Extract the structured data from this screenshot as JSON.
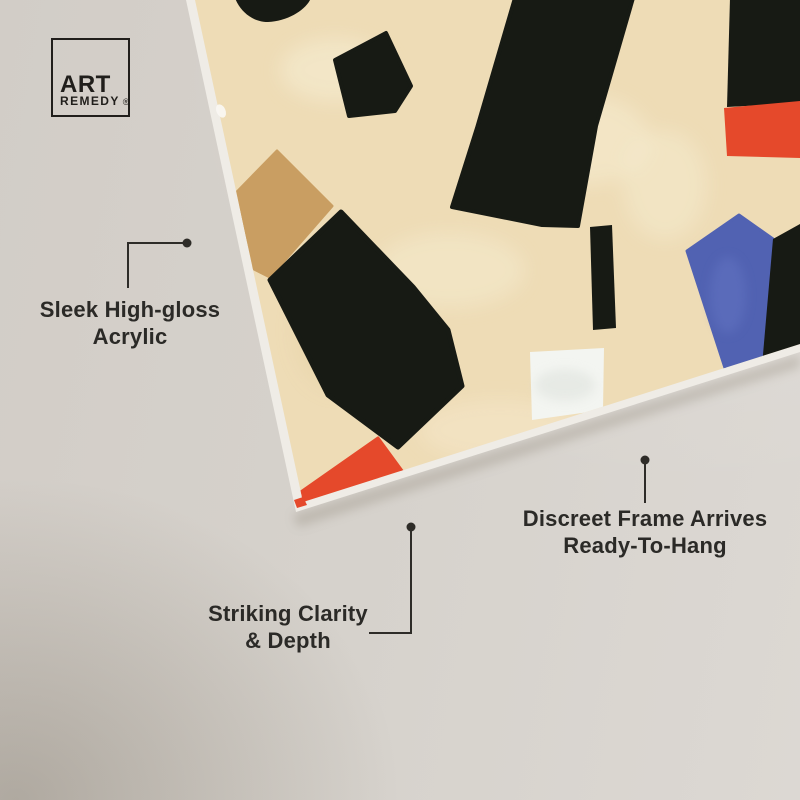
{
  "scene": {
    "description": "Tilted abstract acrylic wall-art print hanging on a warm grey wall, annotated with product feature callouts"
  },
  "logo": {
    "line1": "ART",
    "line2": "REMEDY",
    "mark": "®"
  },
  "callouts": [
    {
      "id": "acrylic",
      "line1": "Sleek High-gloss",
      "line2": "Acrylic"
    },
    {
      "id": "clarity",
      "line1": "Striking Clarity",
      "line2": "& Depth"
    },
    {
      "id": "frame",
      "line1": "Discreet Frame Arrives",
      "line2": "Ready-To-Hang"
    }
  ],
  "palette": {
    "wall": "#d6d2cc",
    "wall_shadow_corner": "#bcb4ab",
    "canvas_side_edge": "#efece6",
    "painting_background": "#eedcb6",
    "shape_black": "#171a14",
    "shape_tan": "#c99e62",
    "shape_orange": "#e5492b",
    "shape_blue": "#5162b2",
    "shape_white": "#f3f5f1",
    "connector_line": "#2e2c28",
    "text": "#2b2a27"
  }
}
